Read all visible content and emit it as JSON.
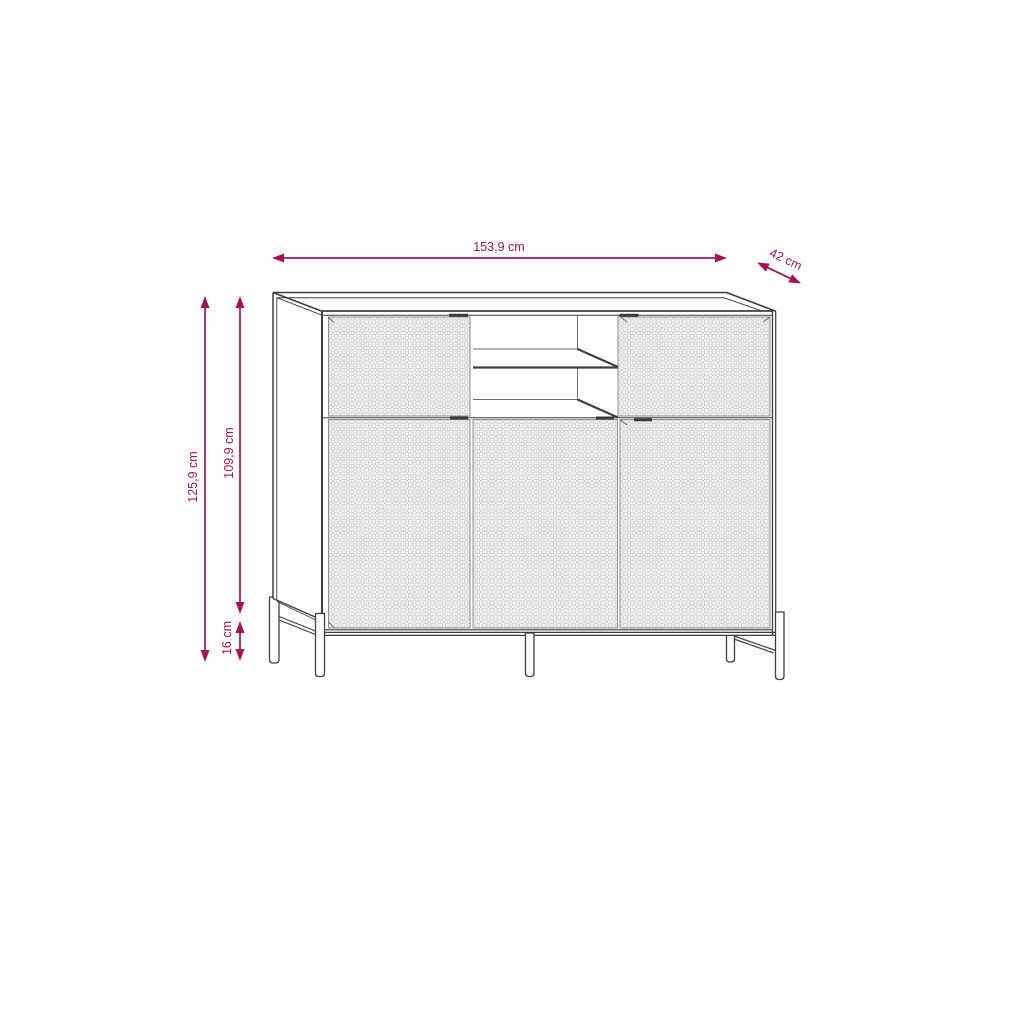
{
  "diagram": {
    "dimensions": {
      "width": "153,9 cm",
      "depth": "42 cm",
      "total_height": "125,9 cm",
      "cabinet_height": "109,9 cm",
      "leg_height": "16 cm"
    },
    "colors": {
      "dimension": "#a51357",
      "outline": "#3f3f3f",
      "pattern_fill": "#e9e9e9",
      "background": "#ffffff"
    }
  }
}
